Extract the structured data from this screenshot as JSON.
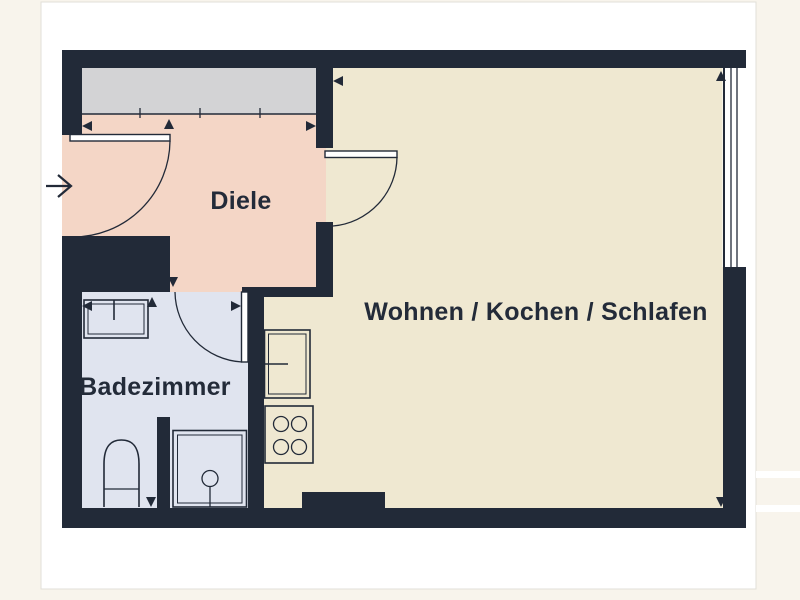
{
  "page": {
    "background_color": "#f8f4ec",
    "canvas_color": "#ffffff",
    "canvas_border_color": "#e2dfd8"
  },
  "plan": {
    "wall_color": "#222a38",
    "outline_color": "#222a38",
    "label_color": "#232b39",
    "wardrobe_fill": "#d3d3d5",
    "window_fill": "#ffffff",
    "rooms": [
      {
        "name": "diele",
        "label": "Diele",
        "fill": "#f4d6c6"
      },
      {
        "name": "badezimmer",
        "label": "Badezimmer",
        "fill": "#e0e4ef"
      },
      {
        "name": "wohnen-kochen-schlafen",
        "label": "Wohnen / Kochen / Schlafen",
        "fill": "#efe8d1"
      }
    ],
    "fixtures": [
      "wardrobe",
      "entrance-door",
      "hallway-door",
      "bathroom-door",
      "sink",
      "toilet",
      "shower",
      "refrigerator",
      "stove",
      "window"
    ]
  }
}
